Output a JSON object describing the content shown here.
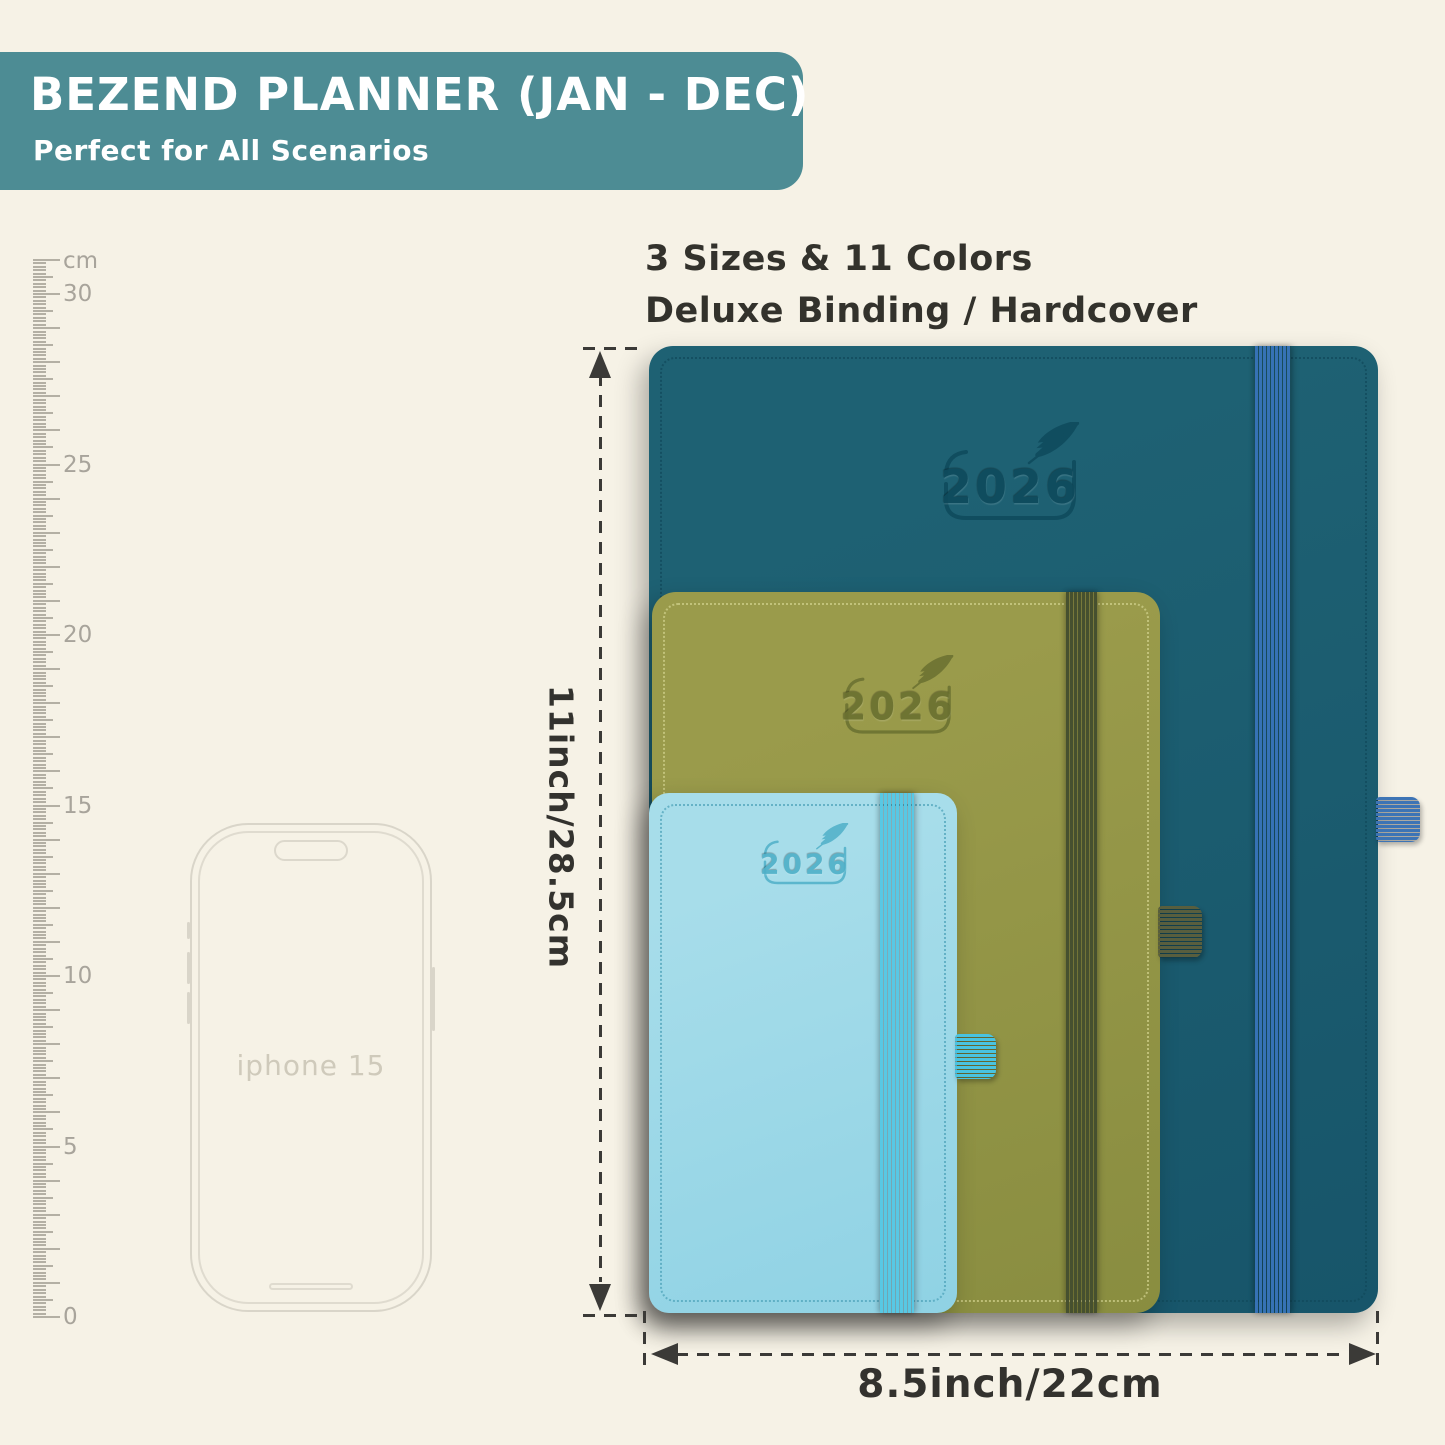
{
  "page": {
    "background": "#f6f2e6"
  },
  "banner": {
    "title": "BEZEND PLANNER (JAN - DEC)",
    "subtitle": "Perfect for All Scenarios",
    "bg_color": "#4d8c94",
    "text_color": "#ffffff"
  },
  "features": {
    "line1": "3 Sizes & 11 Colors",
    "line2": "Deluxe Binding / Hardcover",
    "text_color": "#33322c"
  },
  "ruler": {
    "unit_label": "cm",
    "max_cm": 31,
    "px_per_cm": 34.1,
    "zero_y": 1317,
    "labels": [
      0,
      5,
      10,
      15,
      20,
      25,
      30
    ],
    "tick_color": "#b4b0a4",
    "label_color": "#a8a49b"
  },
  "phone": {
    "label": "iphone 15",
    "outline_color": "#d9d5c9",
    "label_color": "#cfcabb"
  },
  "dimensions": {
    "height_label": "11inch/28.5cm",
    "width_label": "8.5inch/22cm",
    "line_color": "#3b3a37",
    "text_color": "#33322e"
  },
  "planners": [
    {
      "name": "large-planner",
      "size": "large",
      "year": "2026",
      "cover_color": "#1e6173",
      "cover_color_2": "#17556a",
      "band_color": "#3672b5",
      "stitch_color": "#114a5c",
      "loop_color": "#3d74b5",
      "logo_color": "#0e4a5c"
    },
    {
      "name": "medium-planner",
      "size": "medium",
      "year": "2026",
      "cover_color": "#9a9b4b",
      "cover_color_2": "#898d40",
      "band_color": "#46502f",
      "stitch_color": "#cfcf8a",
      "loop_color": "#585e3e",
      "logo_color": "#6a7030"
    },
    {
      "name": "small-planner",
      "size": "small",
      "year": "2026",
      "cover_color": "#a7ddea",
      "cover_color_2": "#8fd2e4",
      "band_color": "#58c8e4",
      "stitch_color": "#4fa4bb",
      "loop_color": "#49c3e0",
      "logo_color": "#4fb0c8"
    }
  ]
}
